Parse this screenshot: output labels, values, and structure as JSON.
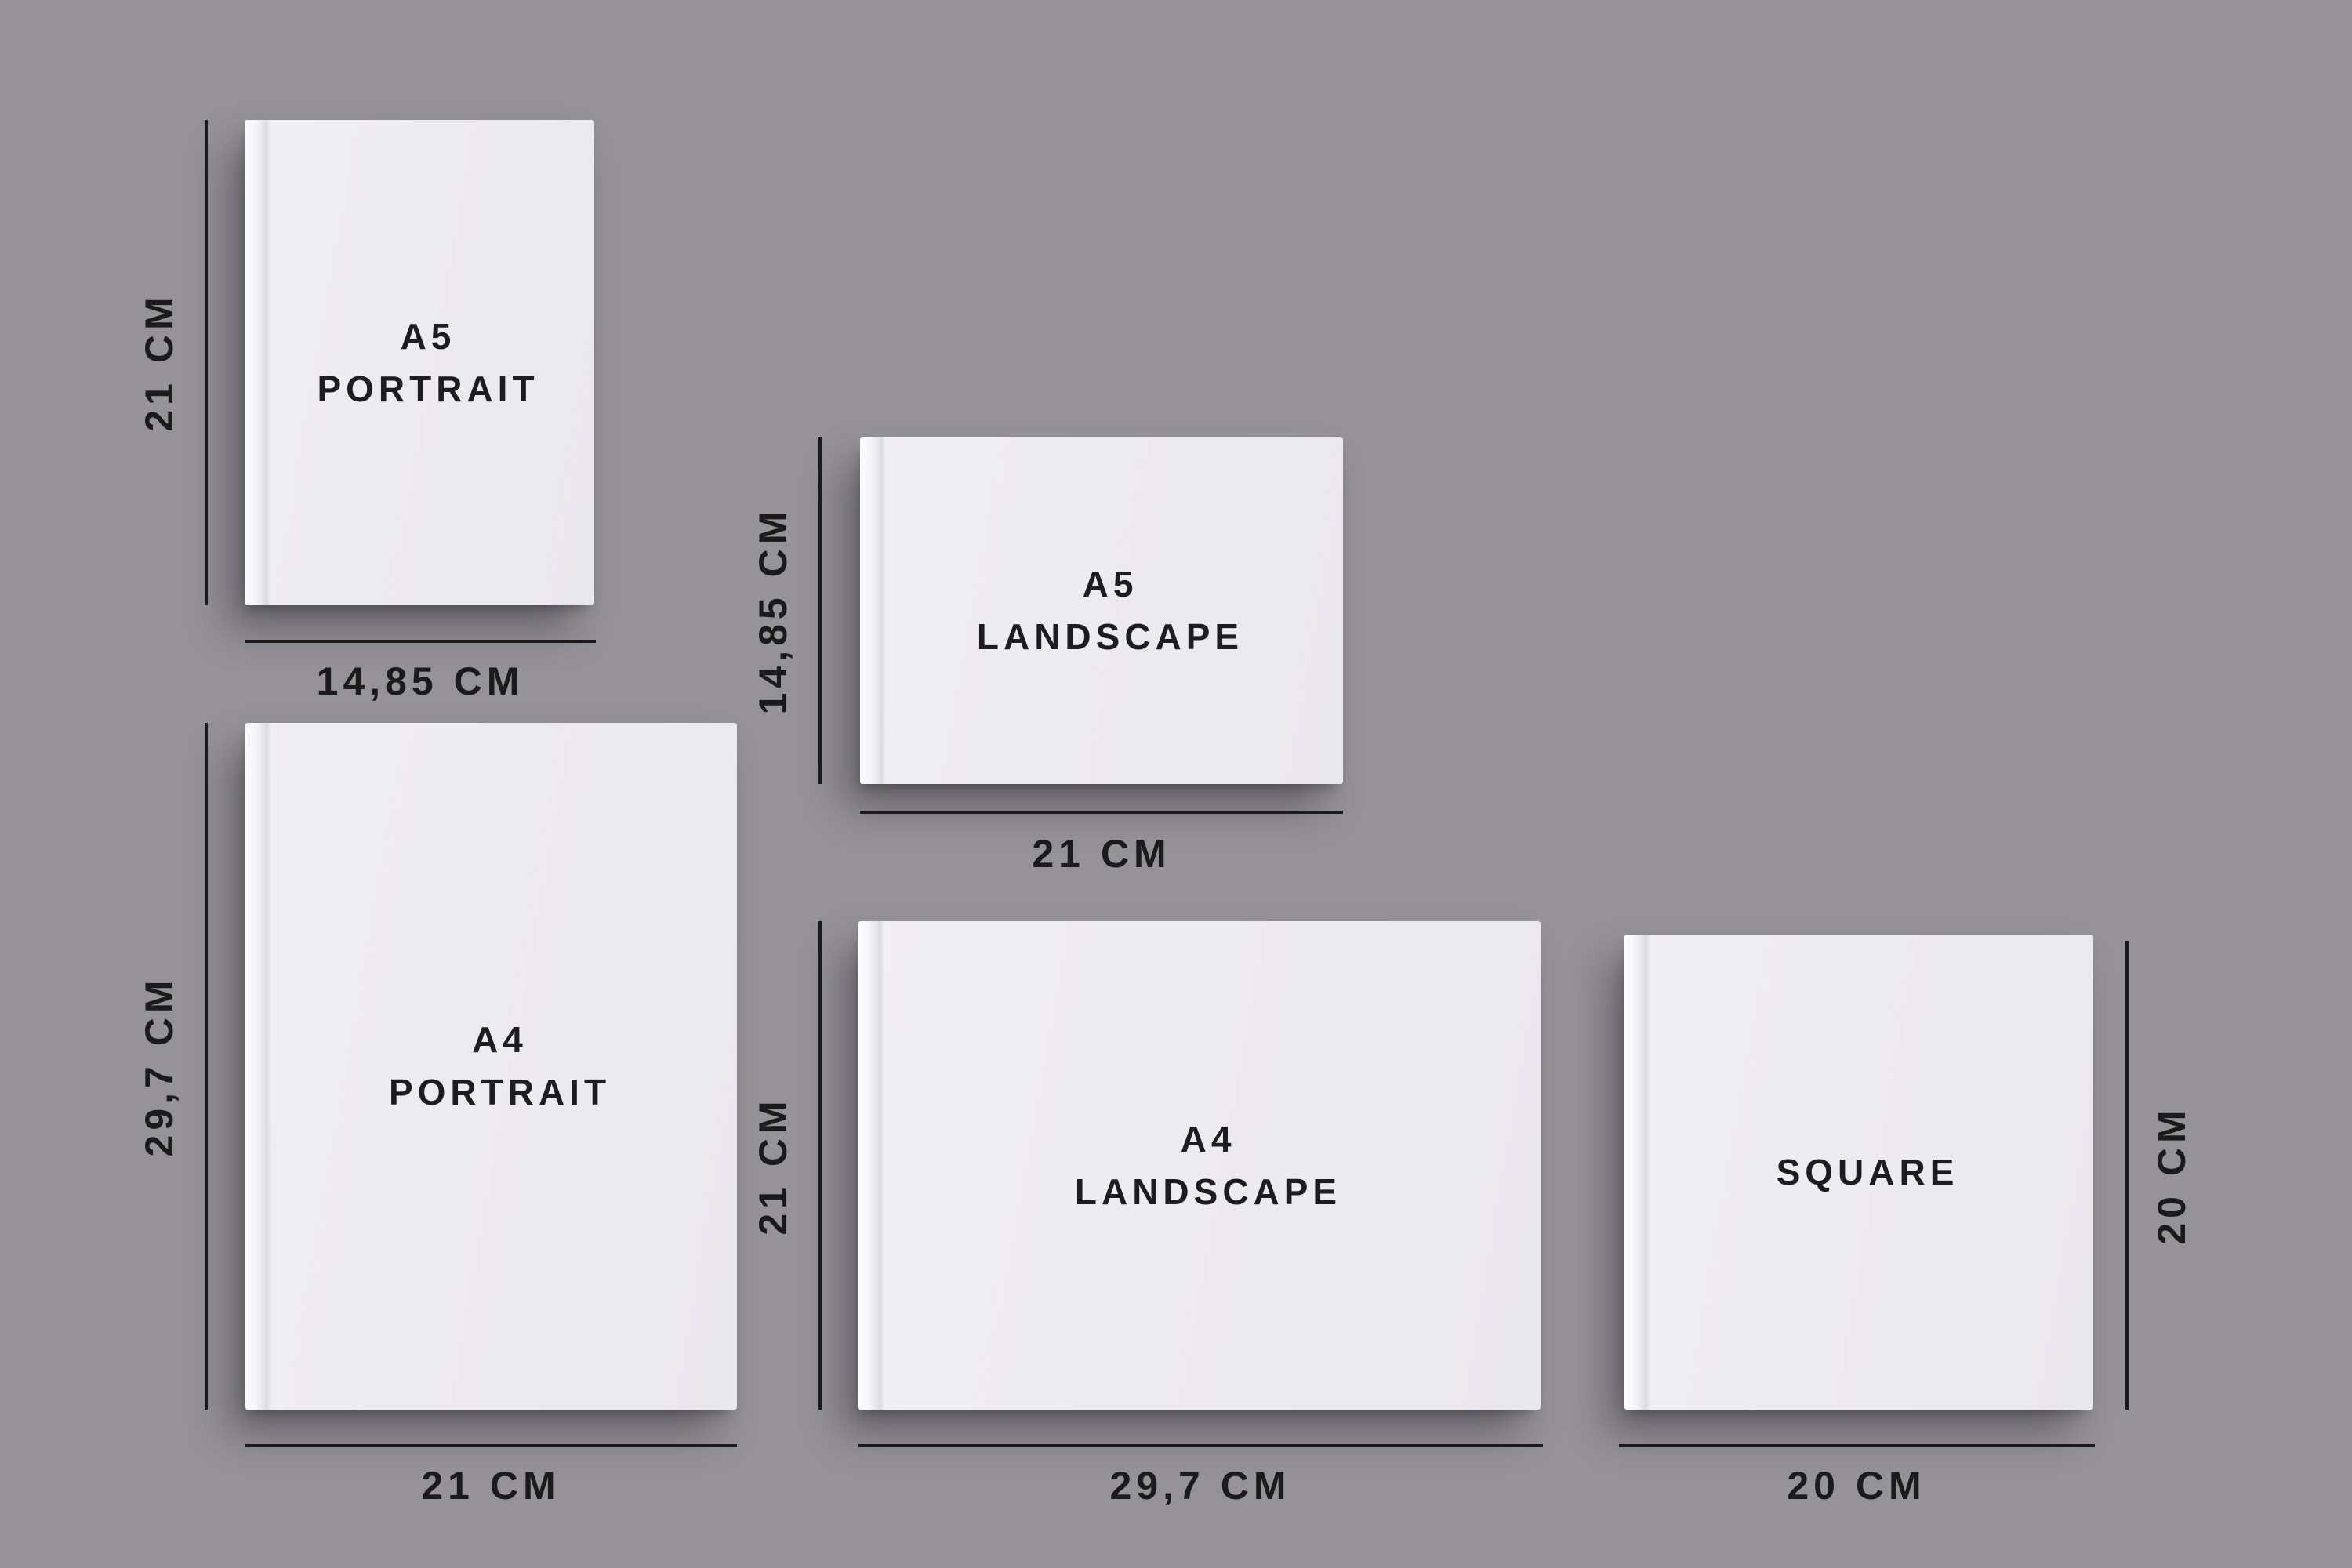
{
  "page": {
    "background_color": "#959398",
    "dimension_color": "#1b1b1b",
    "book_cover_color": "#ecebef"
  },
  "books": [
    {
      "id": "a5-portrait",
      "title_lines": [
        "A5",
        "PORTRAIT"
      ],
      "height_label": "21 CM",
      "width_label": "14,85 CM"
    },
    {
      "id": "a5-landscape",
      "title_lines": [
        "A5",
        "LANDSCAPE"
      ],
      "height_label": "14,85 CM",
      "width_label": "21 CM"
    },
    {
      "id": "a4-portrait",
      "title_lines": [
        "A4",
        "PORTRAIT"
      ],
      "height_label": "29,7 CM",
      "width_label": "21 CM"
    },
    {
      "id": "a4-landscape",
      "title_lines": [
        "A4",
        "LANDSCAPE"
      ],
      "height_label": "21 CM",
      "width_label": "29,7 CM"
    },
    {
      "id": "square",
      "title_lines": [
        "SQUARE"
      ],
      "height_label": "20 CM",
      "width_label": "20 CM"
    }
  ]
}
